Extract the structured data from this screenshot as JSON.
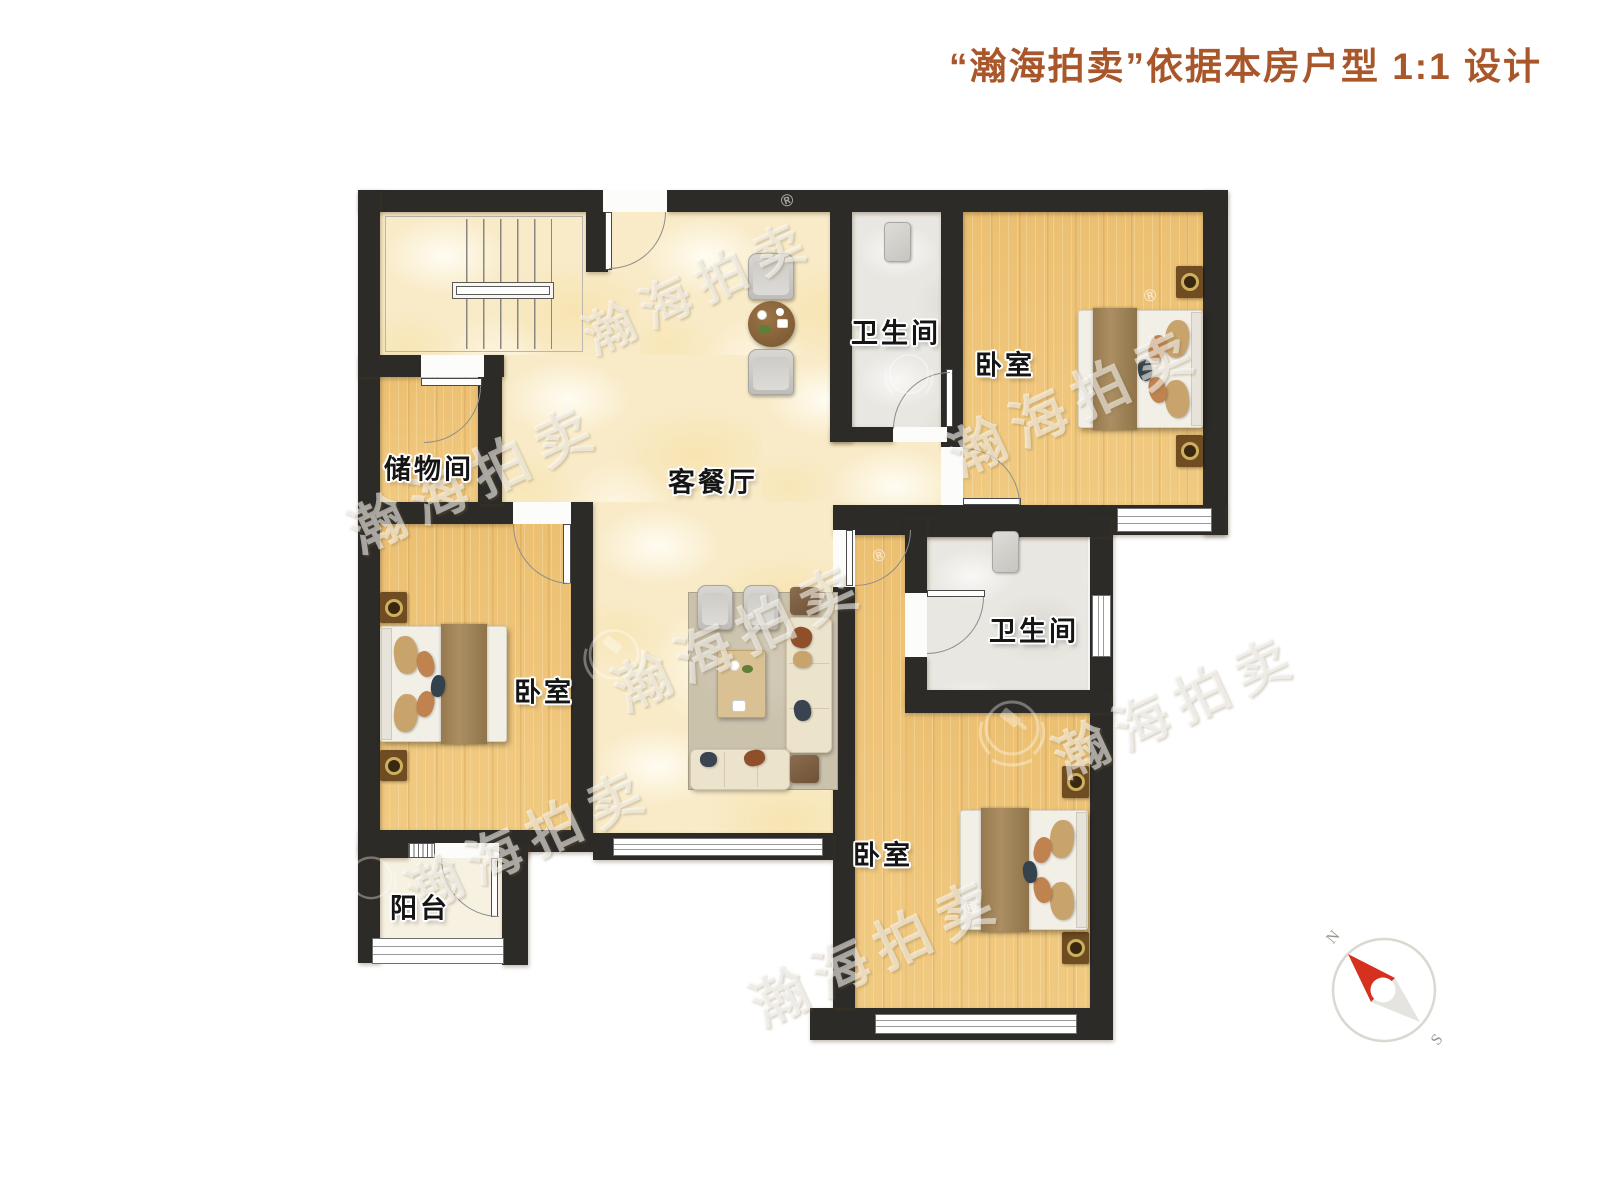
{
  "title": {
    "text": "“瀚海拍卖”依据本房户型 1:1 设计"
  },
  "rooms": {
    "living_dining": "客餐厅",
    "bathroom_top": "卫生间",
    "bathroom_middle": "卫生间",
    "bedroom_top_right": "卧室",
    "bedroom_left": "卧室",
    "bedroom_bottom_right": "卧室",
    "storage": "储物间",
    "balcony": "阳台"
  },
  "compass": {
    "north": "N",
    "south": "S"
  },
  "watermark": {
    "brand": "瀚海拍卖",
    "registered": "®"
  },
  "colors": {
    "title_text": "#a9572a",
    "wall": "#2d2b28",
    "marble_floor": "#f9ebc8",
    "wood_floor": "#efc67c",
    "bathroom_floor": "#e9e7e1",
    "compass_needle": "#d6301f"
  }
}
